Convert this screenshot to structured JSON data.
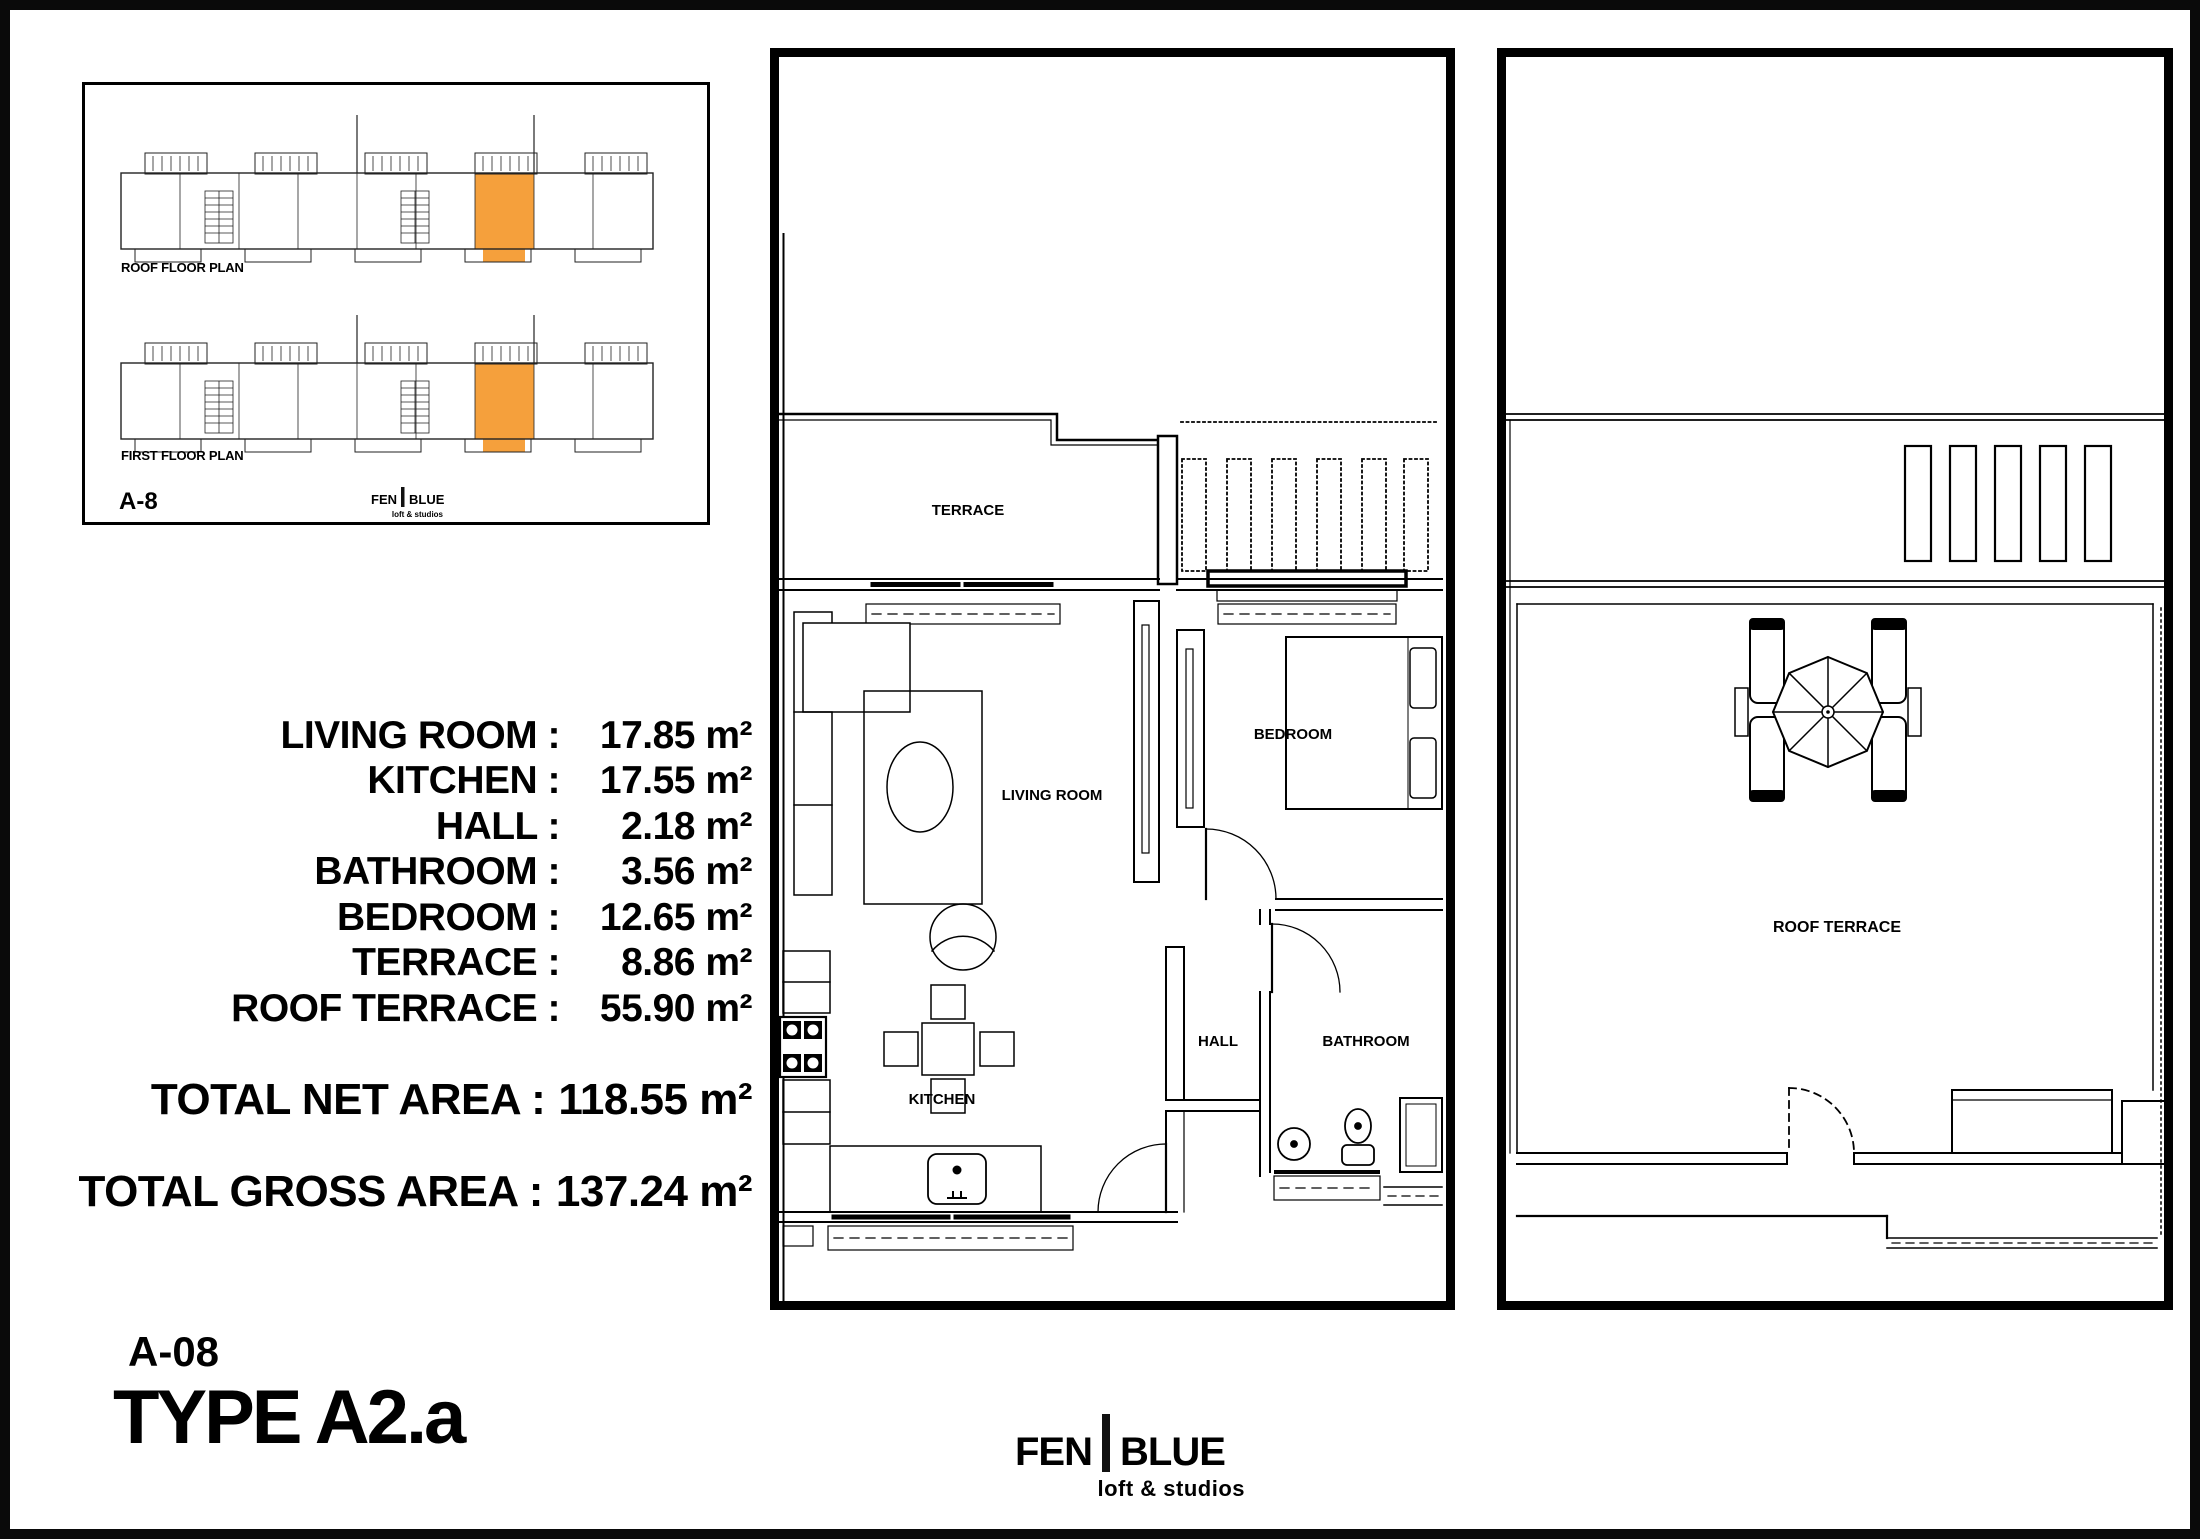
{
  "colors": {
    "highlight_orange": "#F5A03C",
    "line": "#000000"
  },
  "overview_inset": {
    "roof_floor_plan_label": "ROOF FLOOR PLAN",
    "first_floor_plan_label": "FIRST FLOOR PLAN",
    "sheet_ref": "A-8",
    "logo": {
      "name_left": "FEN",
      "name_right": "BLUE",
      "tagline": "loft & studios"
    }
  },
  "area_schedule": {
    "rows": [
      {
        "label": "LIVING ROOM :",
        "value": "17.85 m²"
      },
      {
        "label": "KITCHEN :",
        "value": "17.55 m²"
      },
      {
        "label": "HALL :",
        "value": "2.18 m²"
      },
      {
        "label": "BATHROOM :",
        "value": "3.56 m²"
      },
      {
        "label": "BEDROOM :",
        "value": "12.65 m²"
      },
      {
        "label": "TERRACE :",
        "value": "8.86 m²"
      },
      {
        "label": "ROOF TERRACE :",
        "value": "55.90 m²"
      }
    ],
    "total_net": {
      "label": "TOTAL NET AREA :",
      "value": "118.55 m²"
    },
    "total_gross": {
      "label": "TOTAL GROSS AREA :",
      "value": "137.24 m²"
    }
  },
  "unit": {
    "code": "A-08",
    "type_name": "TYPE A2.a"
  },
  "first_floor_plan": {
    "rooms": {
      "terrace": "TERRACE",
      "living_room": "LIVING ROOM",
      "bedroom": "BEDROOM",
      "hall": "HALL",
      "bathroom": "BATHROOM",
      "kitchen": "KITCHEN"
    }
  },
  "roof_floor_plan": {
    "rooms": {
      "roof_terrace": "ROOF TERRACE"
    }
  },
  "brand": {
    "name_left": "FEN",
    "name_right": "BLUE",
    "tagline": "loft & studios"
  }
}
